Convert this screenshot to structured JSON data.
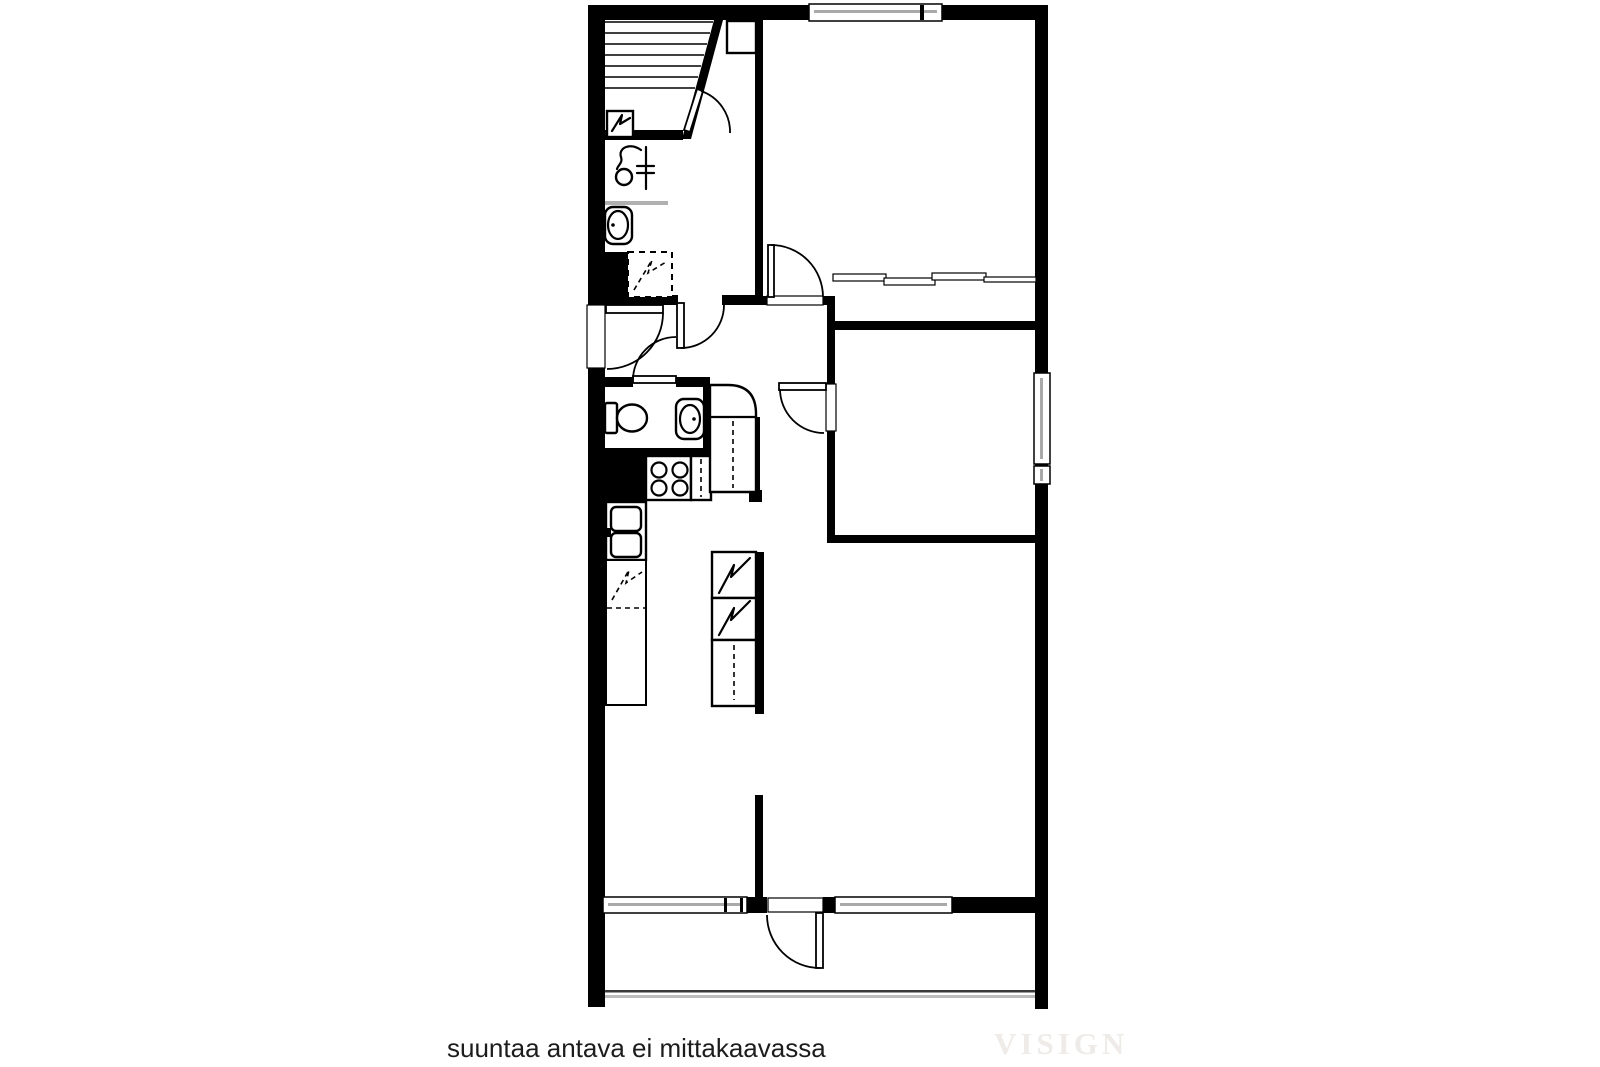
{
  "footer": {
    "disclaimer": "suuntaa antava ei mittakaavassa",
    "watermark": "VISIGN"
  },
  "palette": {
    "wall": "#000000",
    "background": "#ffffff",
    "window_glass": "#a9a9a9",
    "railing": "#bdbdbd",
    "shelf": "#b0b0b0",
    "watermark": "#eeebe8",
    "text": "#1c1c1c"
  },
  "icons": {
    "electrical-panel": "lightning-bolt-in-square",
    "water-heater": "dashed-lightning-bolt-in-dashed-square",
    "dishwasher": "dashed-lightning-bolt-in-counter",
    "appliance-tower": "two-stacked-lightning-bolt-boxes",
    "shower-mixer": "hose-curve-with-head-circle-and-riser",
    "toilet": "tank-and-bowl",
    "sink": "oval-basin-with-tap-dot",
    "kitchen-sink": "double-basin-with-faucet",
    "stove": "four-burner-circles",
    "fridge": "rounded-corner-cabinet",
    "wardrobe": "sliding-door-segments",
    "staircase": "parallel-treads-with-diagonal-stringer"
  }
}
